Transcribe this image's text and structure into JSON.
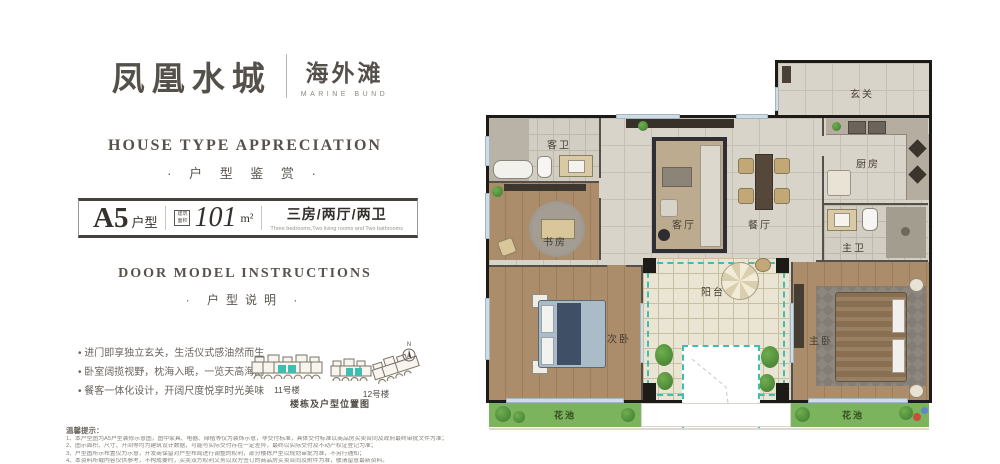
{
  "brand": {
    "name_cn": "凤凰水城",
    "sub_cn": "海外滩",
    "sub_en": "MARINE BUND"
  },
  "appreciation": {
    "title_en": "HOUSE TYPE APPRECIATION",
    "title_cn": "· 户 型 鉴 赏 ·"
  },
  "spec": {
    "type_code": "A5",
    "type_suffix": "户型",
    "area_label": "建筑面积",
    "area_value": "101",
    "area_unit": "m²",
    "layout_cn": "三房/两厅/两卫",
    "layout_en": "Three bedrooms,Two living rooms and Two bathrooms"
  },
  "instructions": {
    "title_en": "DOOR MODEL INSTRUCTIONS",
    "title_cn": "· 户型说明 ·"
  },
  "bullets": [
    "进门即享独立玄关，生活仪式感油然而生",
    "卧室阔揽视野，枕海入眠，一览天高海阔",
    "餐客一体化设计，开阔尺度悦享时光美味"
  ],
  "buildings": {
    "b11_label": "11号楼",
    "b12_label": "12号楼",
    "caption": "楼栋及户型位置图",
    "compass_n": "N"
  },
  "disclaimer": {
    "title": "温馨提示：",
    "lines": [
      "1、本户型图为A5户型装修示意图，图中家具、电器、绿植等仅为装饰示意，非交付标准，具体交付标准以商品房买卖合同及政府最终审批文件为准；",
      "2、图示面积、尺寸、开间等均为建筑设计数据，可能与实际交付存在一定差异，最终以实际交付及不动产权证登记为准；",
      "3、户型图所示布置仅为示意，开发商保留对户型布局进行调整的权利，部分楼栋户型以规划审批为准，不另行通知；",
      "4、本资料所载内容仅供参考，不构成要约，买卖双方权利义务以双方签订的商品房买卖合同及附件为准，敬请留意最新资料。"
    ]
  },
  "floorplan": {
    "rooms": {
      "entrance": "玄关",
      "guest_bath": "客卫",
      "kitchen": "厨房",
      "living": "客厅",
      "dining": "餐厅",
      "study": "书房",
      "master_bath": "主卫",
      "bedroom_second": "次卧",
      "balcony": "阳台",
      "master_bedroom": "主卧",
      "flower_bed_left": "花池",
      "flower_bed_right": "花池"
    }
  },
  "colors": {
    "accent_teal": "#3fbdb0",
    "wall_black": "#1d1b18",
    "wood": "#a98a69",
    "green": "#7cb45e",
    "text_dark": "#55504a"
  }
}
